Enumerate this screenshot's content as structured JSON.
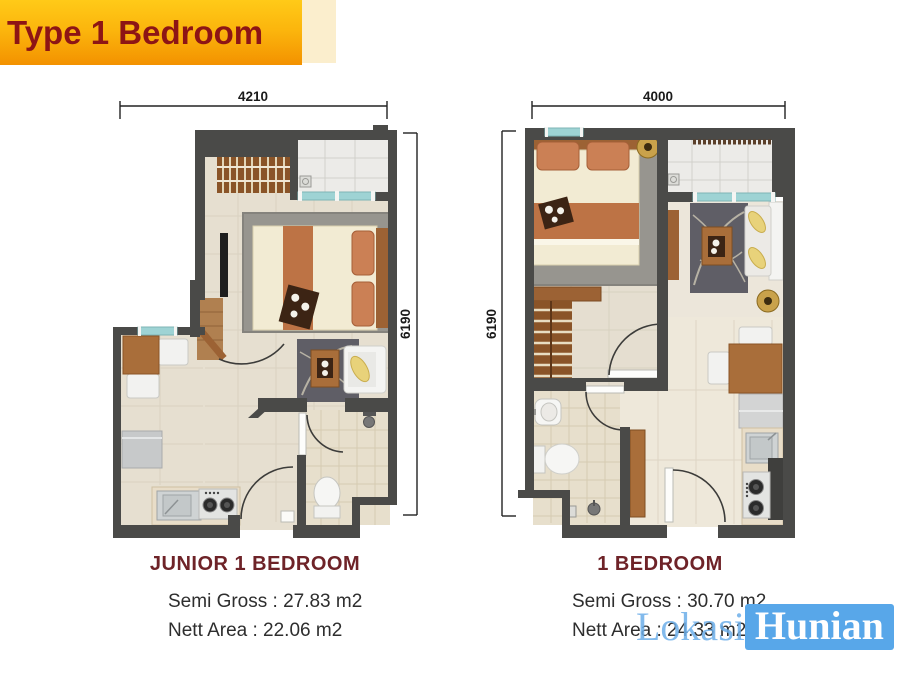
{
  "banner": {
    "title": "Type 1 Bedroom"
  },
  "plans": {
    "left": {
      "name": "JUNIOR 1 BEDROOM",
      "semi_gross": "Semi Gross : 27.83 m2",
      "nett_area": "Nett Area : 22.06 m2",
      "dim_width": "4210",
      "dim_height": "6190"
    },
    "right": {
      "name": "1 BEDROOM",
      "semi_gross": "Semi Gross : 30.70 m2",
      "nett_area": "Nett Area : 24.33 m2",
      "dim_width": "4000",
      "dim_height": "6190"
    }
  },
  "watermark": {
    "part1": "Lokasi",
    "part2": "Hunian"
  },
  "colors": {
    "banner_top": "#ffca18",
    "banner_bottom": "#f39200",
    "title_text": "#8d1515",
    "plan_name_text": "#6e2328",
    "wall": "#4a4a48",
    "floor": "#e6dfd0",
    "watermark_blue": "#58a7e9",
    "window_glass": "#9ed3d4"
  }
}
